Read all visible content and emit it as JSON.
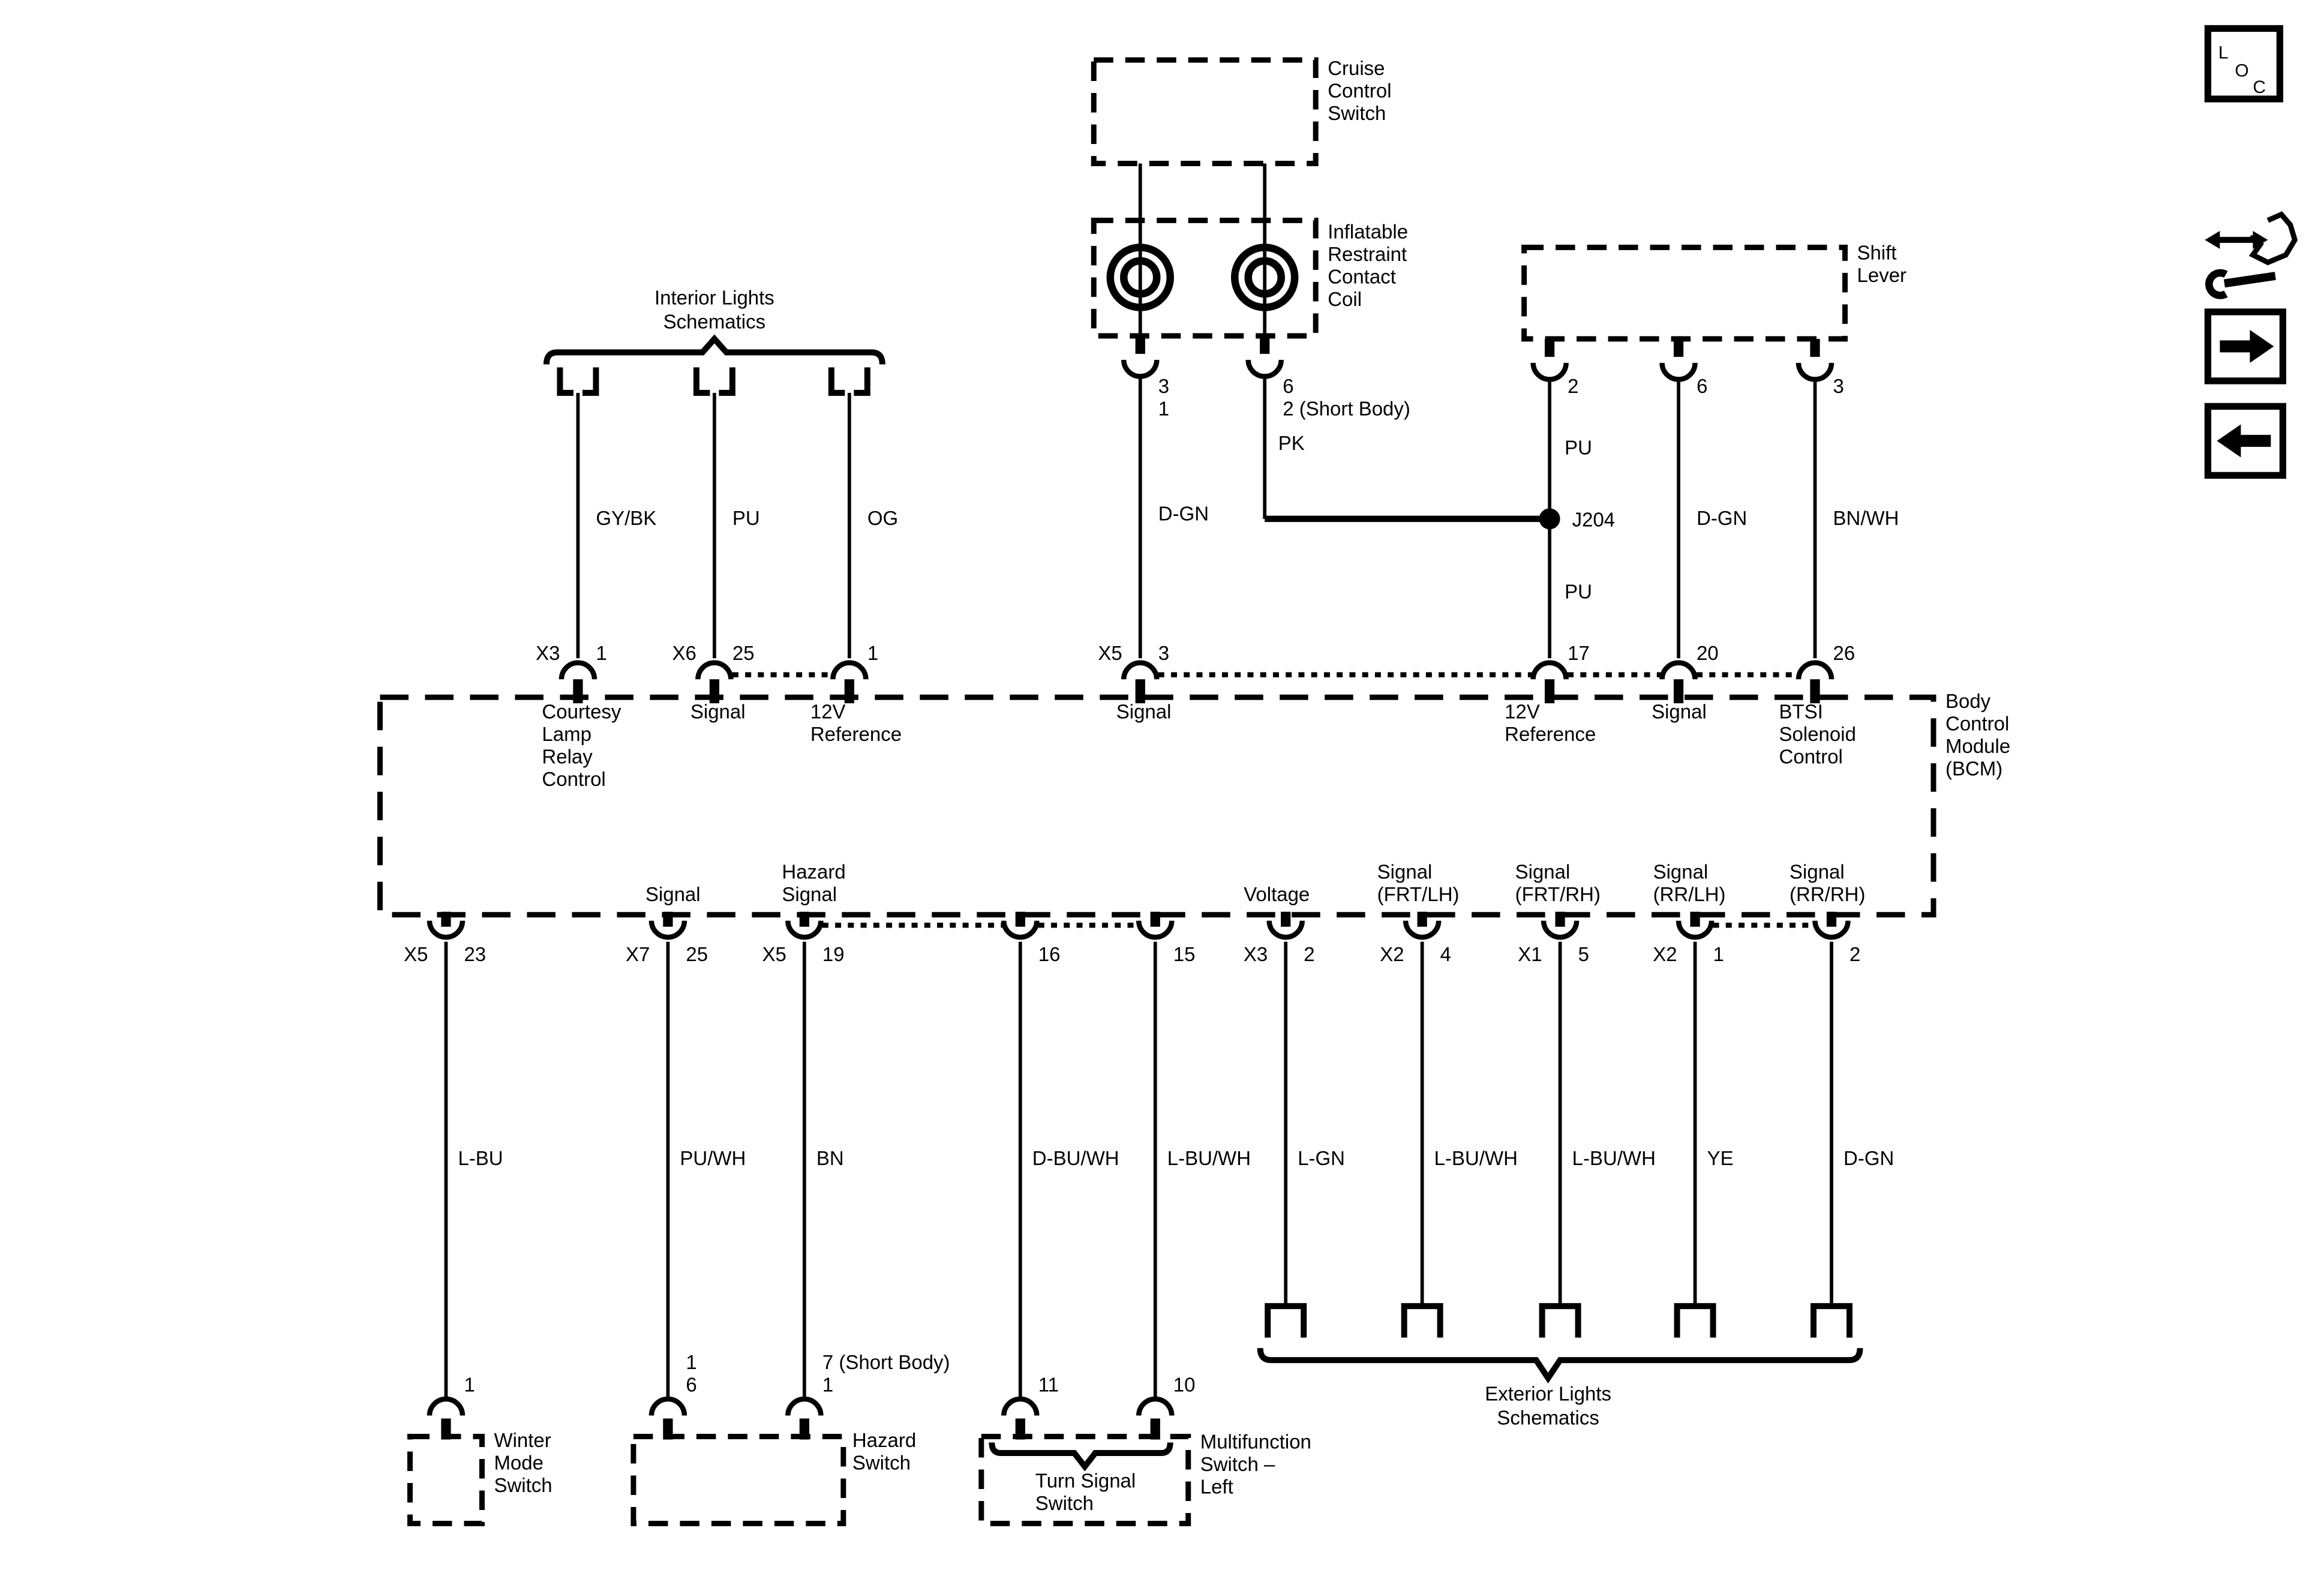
{
  "components": {
    "interior": {
      "label": [
        "Interior Lights",
        "Schematics"
      ]
    },
    "cruise": {
      "label": [
        "Cruise",
        "Control",
        "Switch"
      ],
      "pins": {
        "left_top": "3",
        "left_bottom": "1",
        "right_top": "6",
        "right_bottom": "2 (Short Body)"
      }
    },
    "coil": {
      "label": [
        "Inflatable",
        "Restraint",
        "Contact",
        "Coil"
      ]
    },
    "shift": {
      "label": [
        "Shift",
        "Lever"
      ],
      "pins": [
        "2",
        "6",
        "3"
      ]
    },
    "junction": {
      "label": "J204"
    },
    "bcm": {
      "label": [
        "Body",
        "Control",
        "Module",
        "(BCM)"
      ],
      "top_pins": [
        {
          "conn": "X3",
          "pin": "1",
          "fn": [
            "Courtesy",
            "Lamp",
            "Relay",
            "Control"
          ]
        },
        {
          "conn": "X6",
          "pin": "25",
          "fn": [
            "Signal"
          ]
        },
        {
          "conn": "",
          "pin": "1",
          "fn": [
            "12V",
            "Reference"
          ]
        },
        {
          "conn": "X5",
          "pin": "3",
          "fn": [
            "Signal"
          ]
        },
        {
          "conn": "",
          "pin": "17",
          "fn": [
            "12V",
            "Reference"
          ]
        },
        {
          "conn": "",
          "pin": "20",
          "fn": [
            "Signal"
          ]
        },
        {
          "conn": "",
          "pin": "26",
          "fn": [
            "BTSI",
            "Solenoid",
            "Control"
          ]
        }
      ],
      "bottom_pins": [
        {
          "conn": "X5",
          "pin": "23",
          "fn": []
        },
        {
          "conn": "X7",
          "pin": "25",
          "fn": [
            "Signal"
          ]
        },
        {
          "conn": "X5",
          "pin": "19",
          "fn": [
            "Hazard",
            "Signal"
          ]
        },
        {
          "conn": "",
          "pin": "16",
          "fn": []
        },
        {
          "conn": "",
          "pin": "15",
          "fn": []
        },
        {
          "conn": "X3",
          "pin": "2",
          "fn": [
            "Voltage"
          ]
        },
        {
          "conn": "X2",
          "pin": "4",
          "fn": [
            "Signal",
            "(FRT/LH)"
          ]
        },
        {
          "conn": "X1",
          "pin": "5",
          "fn": [
            "Signal",
            "(FRT/RH)"
          ]
        },
        {
          "conn": "X2",
          "pin": "1",
          "fn": [
            "Signal",
            "(RR/LH)"
          ]
        },
        {
          "conn": "",
          "pin": "2",
          "fn": [
            "Signal",
            "(RR/RH)"
          ]
        }
      ]
    },
    "winter": {
      "label": [
        "Winter",
        "Mode",
        "Switch"
      ],
      "pin": "1"
    },
    "hazard": {
      "label": [
        "Hazard",
        "Switch"
      ],
      "left_pin": [
        "1",
        "6"
      ],
      "right_pin": [
        "7 (Short Body)",
        "1"
      ]
    },
    "turn": {
      "label": [
        "Turn Signal",
        "Switch"
      ],
      "pins": [
        "11",
        "10"
      ]
    },
    "multifunction": {
      "label": [
        "Multifunction",
        "Switch –",
        "Left"
      ]
    },
    "exterior": {
      "label": [
        "Exterior Lights",
        "Schematics"
      ]
    }
  },
  "wires": {
    "top": [
      "GY/BK",
      "PU",
      "OG",
      "D-GN",
      "PK",
      "PU",
      "PU",
      "D-GN",
      "BN/WH"
    ],
    "bottom": [
      "L-BU",
      "PU/WH",
      "BN",
      "D-BU/WH",
      "L-BU/WH",
      "L-GN",
      "L-BU/WH",
      "L-BU/WH",
      "YE",
      "D-GN"
    ]
  },
  "nav": {
    "loc": [
      "L",
      "O",
      "C"
    ]
  },
  "colors": {
    "ink": "#000000",
    "paper": "#ffffff"
  }
}
